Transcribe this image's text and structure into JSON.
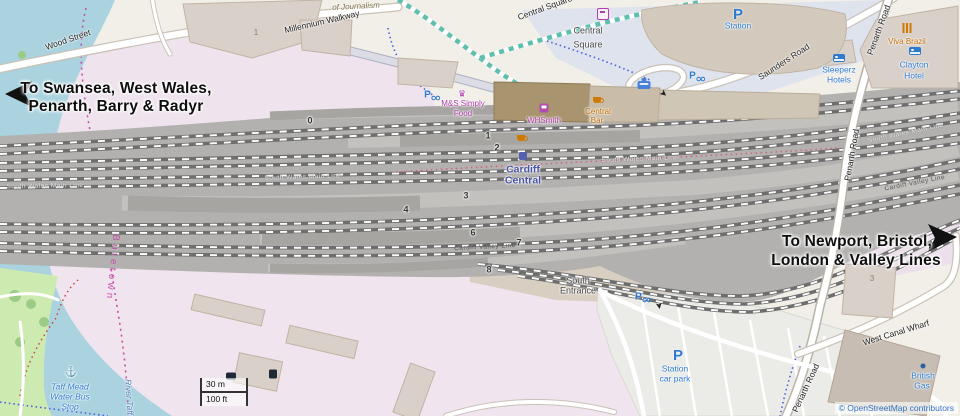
{
  "directions": {
    "west_line1": "To Swansea, West Wales,",
    "west_line2": "Penarth, Barry & Radyr",
    "east_line1": "To Newport, Bristol,",
    "east_line2": "London & Valley Lines"
  },
  "roads": {
    "wood_street": "Wood Street",
    "millennium_walkway": "Millennium Walkway",
    "of_journalism": "of Journalism",
    "central_square_street": "Central Square",
    "saunders_road": "Saunders Road",
    "penarth_road": "Penarth Road",
    "west_canal_wharf": "West Canal Wharf"
  },
  "railway": {
    "station_line1": "Cardiff",
    "station_line2": "Central",
    "main_line": "South Wales Main Line",
    "valley_line": "Cardiff Valley Line",
    "platforms": [
      "0",
      "1",
      "2",
      "3",
      "4",
      "6",
      "7",
      "8"
    ]
  },
  "places": {
    "central_square_line1": "Central",
    "central_square_line2": "Square",
    "south_entrance_line1": "South",
    "south_entrance_line2": "Entrance",
    "butetown": "Butetown",
    "river_taff": "River Taff"
  },
  "pois": {
    "parking_letter": "P",
    "p_station_label": "Station",
    "ms_line1": "M&S Simply",
    "ms_line2": "Food",
    "whsmith": "WHSmith",
    "central_bar_line1": "Central",
    "central_bar_line2": "Bar",
    "sleeperz_line1": "Sleeperz",
    "sleeperz_line2": "Hotels",
    "viva_brazil": "Viva Brazil",
    "clayton_line1": "Clayton",
    "clayton_line2": "Hotel",
    "british_gas_line1": "British",
    "british_gas_line2": "Gas",
    "car_park_line1": "Station",
    "car_park_line2": "car park",
    "water_bus_line1": "Taff Mead",
    "water_bus_line2": "Water Bus",
    "water_bus_line3": "Stop"
  },
  "buildings": {
    "b1": "1",
    "b3": "3"
  },
  "scale_bar": {
    "metric": "30 m",
    "imperial": "100 ft"
  },
  "attribution": "© OpenStreetMap contributors",
  "icons": {
    "crown": "♛",
    "anchor": "⚓"
  },
  "colors": {
    "water": "#aad3df",
    "railway_landuse": "#efe3ed",
    "track_gray": "#6e6e6e",
    "poi_blue": "#2f7ad1",
    "shop_magenta": "#ad3cab",
    "food_orange": "#bf6c00",
    "station_purple": "#4b55a8"
  }
}
